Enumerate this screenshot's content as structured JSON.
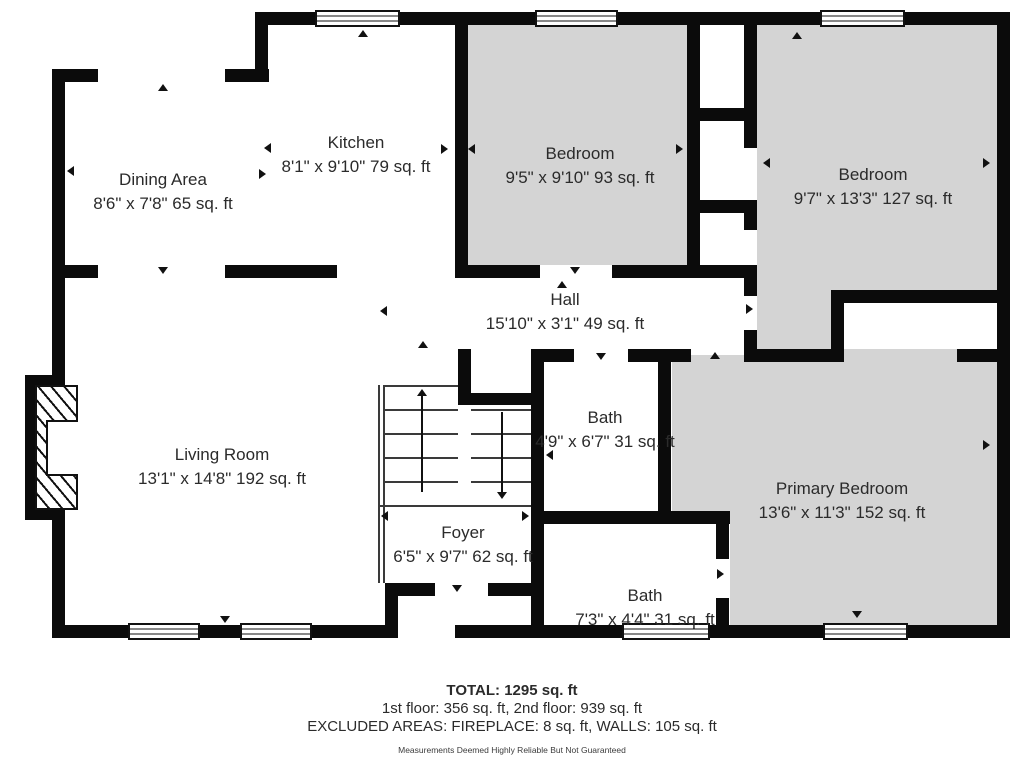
{
  "rooms": {
    "dining": {
      "name": "Dining Area",
      "dims": "8'6\" x 7'8\" 65 sq. ft"
    },
    "kitchen": {
      "name": "Kitchen",
      "dims": "8'1\" x 9'10\" 79 sq. ft"
    },
    "bedroom1": {
      "name": "Bedroom",
      "dims": "9'5\" x 9'10\" 93 sq. ft"
    },
    "bedroom2": {
      "name": "Bedroom",
      "dims": "9'7\" x 13'3\" 127 sq. ft"
    },
    "hall": {
      "name": "Hall",
      "dims": "15'10\" x 3'1\" 49 sq. ft"
    },
    "living": {
      "name": "Living Room",
      "dims": "13'1\" x 14'8\" 192 sq. ft"
    },
    "bath1": {
      "name": "Bath",
      "dims": "4'9\" x 6'7\" 31 sq. ft"
    },
    "foyer": {
      "name": "Foyer",
      "dims": "6'5\" x 9'7\" 62 sq. ft"
    },
    "primary": {
      "name": "Primary Bedroom",
      "dims": "13'6\" x 11'3\" 152 sq. ft"
    },
    "bath2": {
      "name": "Bath",
      "dims": "7'3\" x 4'4\" 31 sq. ft"
    }
  },
  "footer": {
    "total": "TOTAL: 1295 sq. ft",
    "floors": "1st floor: 356 sq. ft, 2nd floor: 939 sq. ft",
    "excluded": "EXCLUDED AREAS: FIREPLACE: 8 sq. ft, WALLS: 105 sq. ft",
    "disclaimer": "Measurements Deemed Highly Reliable But Not Guaranteed"
  },
  "colors": {
    "wall": "#0b0b0b",
    "carpet": "#d4d4d4",
    "background": "#ffffff"
  }
}
